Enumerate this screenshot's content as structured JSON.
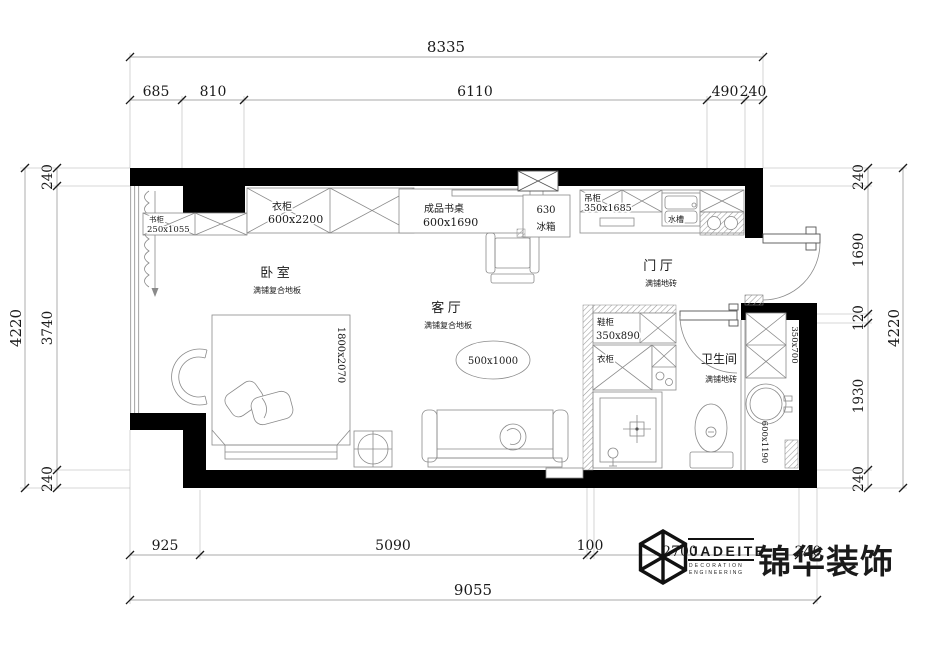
{
  "dimensions": {
    "top": {
      "total": "8335",
      "segments": [
        "685",
        "810",
        "6110",
        "490",
        "240"
      ]
    },
    "bottom": {
      "total": "9055",
      "segments": [
        "925",
        "5090",
        "100",
        "2700",
        "240"
      ]
    },
    "left": {
      "total": "4220",
      "segments": [
        "240",
        "3740",
        "240"
      ]
    },
    "right": {
      "total": "4220",
      "segments": [
        "240",
        "1690",
        "120",
        "1930",
        "240"
      ]
    }
  },
  "rooms": {
    "bedroom": {
      "name": "卧 室",
      "floor": "满铺复合地板"
    },
    "living_room": {
      "name": "客 厅",
      "floor": "满铺复合地板"
    },
    "foyer": {
      "name": "门 厅",
      "floor": "满铺地砖"
    },
    "bathroom": {
      "name": "卫生间",
      "floor": "满铺地砖"
    }
  },
  "furniture": {
    "bookcase": {
      "label": "书柜",
      "size": "250x1055"
    },
    "bedroom_wardrobe": {
      "label": "衣柜",
      "size": "600x2200"
    },
    "desk": {
      "label": "成品书桌",
      "size": "600x1690"
    },
    "fridge": {
      "label": "冰箱",
      "size": "630"
    },
    "hanging_cabinet": {
      "label": "吊柜",
      "size": "350x1685"
    },
    "kitchen_sink": {
      "label": "水槽"
    },
    "shoe_cabinet": {
      "label": "鞋柜",
      "size": "350x890"
    },
    "foyer_wardrobe": {
      "label": "衣柜"
    },
    "bed": {
      "size": "1800x2070"
    },
    "coffee_table": {
      "size": "500x1000"
    },
    "bath_cabinet": {
      "size": "350x700"
    },
    "vanity_counter": {
      "size": "600x1190"
    }
  },
  "logo": {
    "brand": "JADEITE",
    "line1": "DECORATION",
    "line2": "ENGINEERING",
    "company": "锦华装饰"
  },
  "colors": {
    "wall": "#000000",
    "dim_line": "#8c8c8c",
    "text": "#1a1a1a"
  }
}
